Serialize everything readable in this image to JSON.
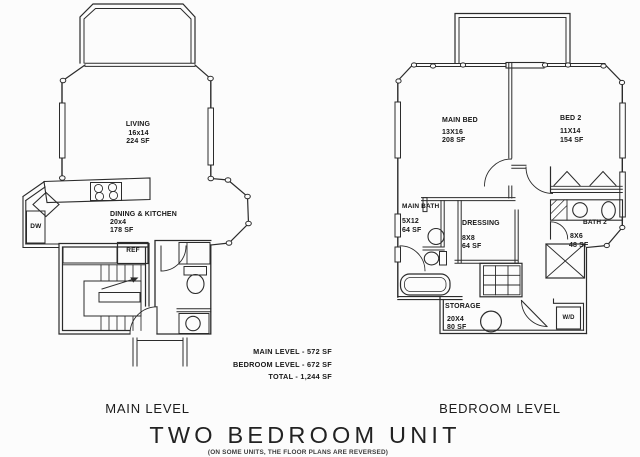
{
  "canvas": {
    "background": "#fcfcfc",
    "line_color": "#2b2b2b"
  },
  "title": {
    "text": "TWO BEDROOM UNIT",
    "note": "(ON SOME UNITS, THE FLOOR PLANS ARE REVERSED)"
  },
  "summary": {
    "main_level": "MAIN LEVEL - 572 SF",
    "bedroom_level": "BEDROOM LEVEL - 672 SF",
    "total": "TOTAL - 1,244 SF"
  },
  "plans": {
    "main_level": {
      "caption": "MAIN LEVEL",
      "rooms": {
        "living": {
          "name": "LIVING",
          "dims": "16x14",
          "area": "224 SF"
        },
        "dining_kitchen": {
          "name": "DINING & KITCHEN",
          "dims": "20x4",
          "area": "178 SF"
        }
      },
      "fixtures": {
        "ref": "REF",
        "dw": "DW"
      }
    },
    "bedroom_level": {
      "caption": "BEDROOM LEVEL",
      "rooms": {
        "main_bed": {
          "name": "MAIN BED",
          "dims": "13X16",
          "area": "208 SF"
        },
        "bed_2": {
          "name": "BED 2",
          "dims": "11X14",
          "area": "154 SF"
        },
        "main_bath": {
          "name": "MAIN BATH",
          "dims": "5X12",
          "area": "64 SF"
        },
        "dressing": {
          "name": "DRESSING",
          "dims": "8X8",
          "area": "64 SF"
        },
        "bath_2": {
          "name": "BATH 2",
          "dims": "8X6",
          "area": "48 SF"
        },
        "storage": {
          "name": "STORAGE",
          "dims": "20X4",
          "area": "80 SF"
        }
      },
      "fixtures": {
        "wd": "W/D"
      }
    }
  }
}
